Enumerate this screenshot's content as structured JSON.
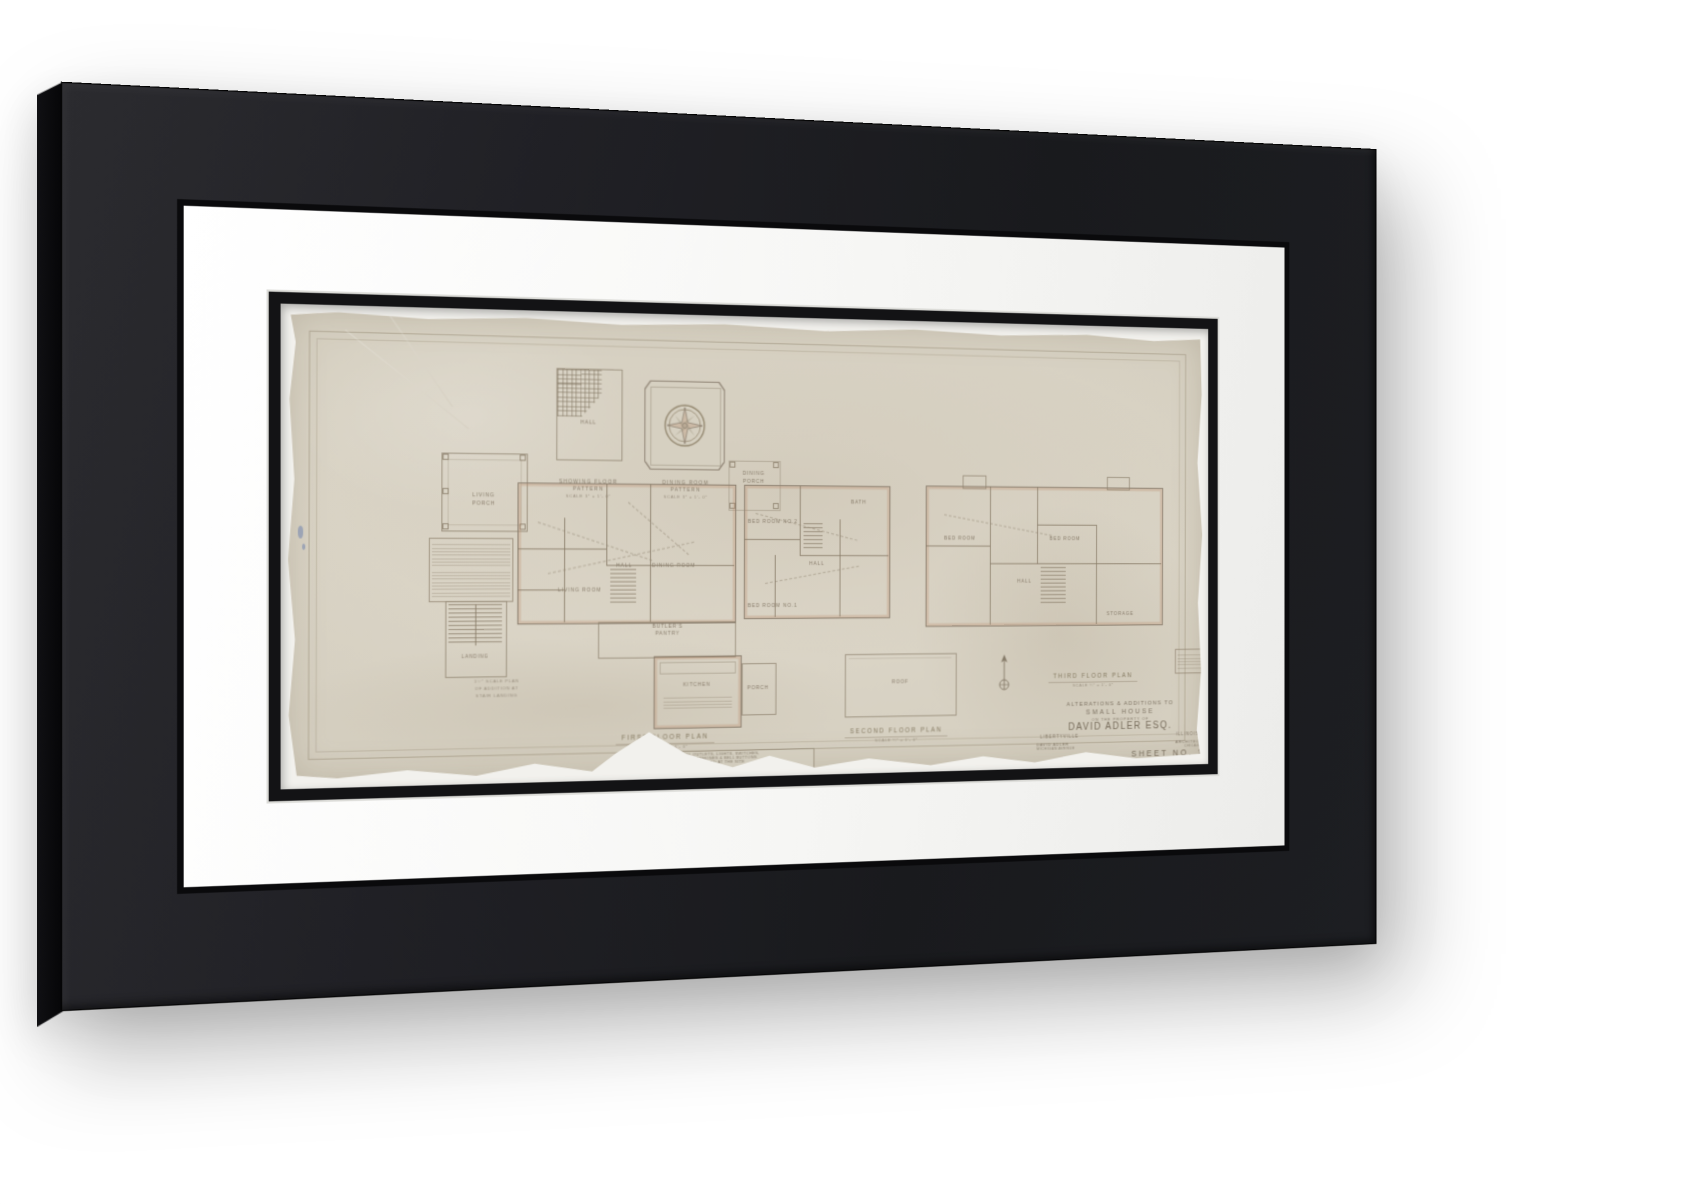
{
  "product": {
    "colors": {
      "frame": "#1d1e22",
      "frame_side": "#060608",
      "mat": "#ffffff",
      "fillet": "#131315",
      "paper": "#d5cfc0",
      "pencil": "#8a7e6d",
      "poche": "#bf8f6f"
    }
  },
  "sheet": {
    "details": {
      "hall_pattern": {
        "room": "HALL",
        "caption": [
          "SHOWING FLOOR",
          "PATTERN",
          "SCALE 3″ = 1′- 0″"
        ]
      },
      "dining_pattern": {
        "caption": [
          "DINING ROOM",
          "PATTERN",
          "SCALE 3″ = 1′- 0″"
        ]
      }
    },
    "first_floor": {
      "title": "FIRST FLOOR PLAN",
      "scale": "SCALE ¼″ = 1′- 0″",
      "rooms": {
        "living_porch_1": "LIVING",
        "living_porch_2": "PORCH",
        "dining_porch_1": "DINING",
        "dining_porch_2": "PORCH",
        "living_room": "LIVING ROOM",
        "hall": "HALL",
        "dining_room": "DINING ROOM",
        "butlers_1": "BUTLER'S",
        "butlers_2": "PANTRY",
        "kitchen": "KITCHEN",
        "porch": "PORCH"
      },
      "note": [
        "NOTE THAT ALL OUTLETS, LIGHTS, SWITCHES,",
        "BASE PLUGS, TELEPHONES & BELL BUTTONS",
        "WILL BE FINALLY LOCATED AT THE SITE",
        "BY THE ARCHITECT."
      ]
    },
    "stair_detail": {
      "room": "LANDING",
      "caption": [
        "1½″ SCALE PLAN",
        "OF ADDITION AT",
        "STAIR LANDING"
      ]
    },
    "second_floor": {
      "title": "SECOND FLOOR PLAN",
      "scale": "SCALE ¼″ = 1′- 0″",
      "rooms": {
        "bed1": "BED ROOM NO.1",
        "bed2": "BED ROOM NO.2",
        "bath": "BATH",
        "hall": "HALL",
        "roof": "ROOF"
      }
    },
    "third_floor": {
      "title": "THIRD FLOOR PLAN",
      "scale": "SCALE ¼″ = 1′- 0″",
      "rooms": {
        "bed1": "BED ROOM",
        "bed2": "BED ROOM",
        "hall": "HALL",
        "storage": "STORAGE"
      }
    },
    "title_block": {
      "project_line1": "ALTERATIONS & ADDITIONS TO",
      "project_line2": "SMALL HOUSE",
      "of_line": "ON THE PROPERTY OF",
      "client": "DAVID ADLER ESQ.",
      "city": "LIBERTYVILLE",
      "state": "ILLINOIS",
      "architect": "DAVID ADLER",
      "architect_address": "MICHIGAN AVENUE",
      "architect_role": "ARCHITECT",
      "architect_city": "CHICAGO",
      "sheet_no": "SHEET NO. 1"
    }
  }
}
